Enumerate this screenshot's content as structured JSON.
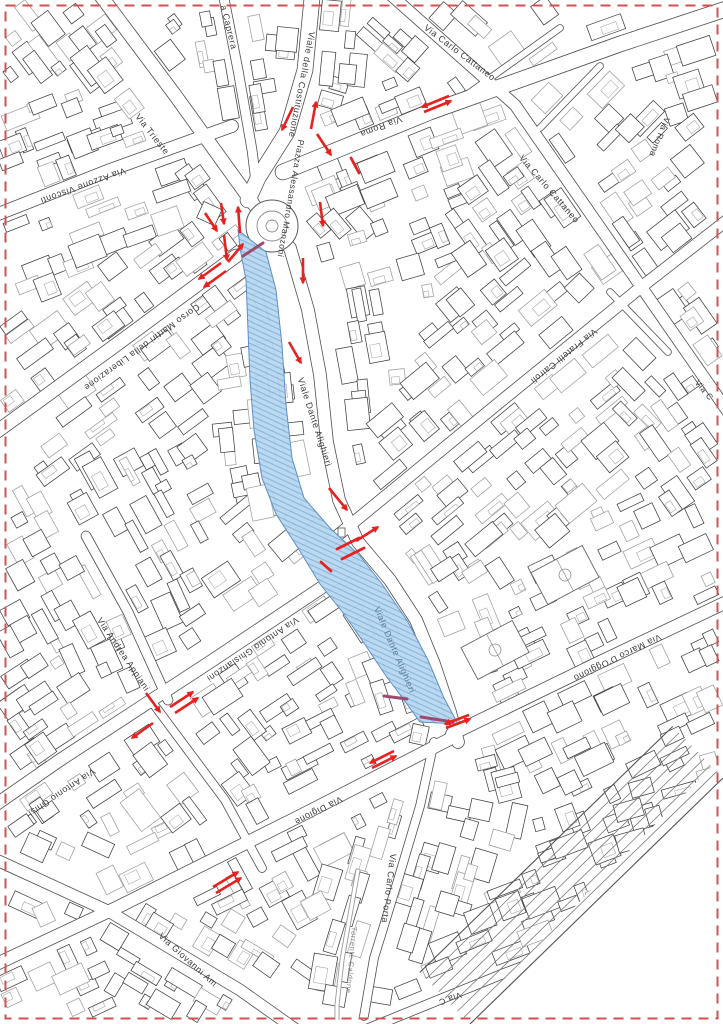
{
  "map": {
    "region_description": "City-centre cadastral street map with highlighted pedestrian zone and traffic-change arrows",
    "colors": {
      "arrow": "#e8211f",
      "zone_fill": "#b7d7f0",
      "zone_hatch": "#84b2da",
      "zone_edge": "#5c8fc4",
      "zone_accent": "#9c4b6e",
      "border": "#d45050",
      "label": "#3c3c3c",
      "water_label": "#8a8a8a",
      "zone_label": "#5e7a9b"
    },
    "street_labels": [
      {
        "text": "Via Trieste",
        "x": 150,
        "y": 136,
        "rot": 52,
        "size": 9
      },
      {
        "text": "a Caprera",
        "x": 226,
        "y": 28,
        "rot": 76,
        "size": 9
      },
      {
        "text": "Viale della Costituzione",
        "x": 299,
        "y": 84,
        "rot": 101,
        "size": 9
      },
      {
        "text": "Via Carlo Cattaneo",
        "x": 458,
        "y": 55,
        "rot": 37,
        "size": 9
      },
      {
        "text": "Via Roma",
        "x": 380,
        "y": 124,
        "rot": 159,
        "size": 9
      },
      {
        "text": "Via Roma",
        "x": 657,
        "y": 136,
        "rot": 112,
        "size": 8.5
      },
      {
        "text": "Via Carlo Cattaneo",
        "x": 547,
        "y": 191,
        "rot": 49,
        "size": 9
      },
      {
        "text": "Via Azzone Visconti",
        "x": 82,
        "y": 183,
        "rot": 160,
        "size": 9
      },
      {
        "text": "Piazza Alessandro Manzoni",
        "x": 288,
        "y": 198,
        "rot": 100,
        "size": 8.5
      },
      {
        "text": "Corso Martiri della Liberazione",
        "x": 140,
        "y": 345,
        "rot": 144,
        "size": 9
      },
      {
        "text": "Viale Dante Alighieri",
        "x": 312,
        "y": 423,
        "rot": 72,
        "size": 9
      },
      {
        "text": "Via Fratelli Cairoli",
        "x": 562,
        "y": 354,
        "rot": 141,
        "size": 9
      },
      {
        "text": "Via C",
        "x": 702,
        "y": 392,
        "rot": 50,
        "size": 8.5
      },
      {
        "text": "Viale Dante Alighieri",
        "x": 392,
        "y": 651,
        "rot": 67,
        "size": 9,
        "color": "zone_label"
      },
      {
        "text": "Via Antonio Ghislanzoni",
        "x": 251,
        "y": 647,
        "rot": 146,
        "size": 9
      },
      {
        "text": "Via Andrea Appiani",
        "x": 121,
        "y": 656,
        "rot": 56,
        "size": 9
      },
      {
        "text": "Via Marco D'Oggiono",
        "x": 616,
        "y": 655,
        "rot": 154,
        "size": 9
      },
      {
        "text": "Via Antonio Ghisl",
        "x": 60,
        "y": 790,
        "rot": 146,
        "size": 9
      },
      {
        "text": "Via Digione",
        "x": 317,
        "y": 808,
        "rot": 153,
        "size": 9
      },
      {
        "text": "Via Carlo Porta",
        "x": 386,
        "y": 888,
        "rot": 97,
        "size": 9
      },
      {
        "text": "Torrente Caldone",
        "x": 349,
        "y": 960,
        "rot": 95,
        "size": 7.5,
        "color": "water_label"
      },
      {
        "text": "Via Giovanni Am",
        "x": 186,
        "y": 962,
        "rot": 42,
        "size": 9
      },
      {
        "text": "Via C",
        "x": 449,
        "y": 996,
        "rot": 160,
        "size": 8.5
      }
    ],
    "traffic_arrows": [
      {
        "x1": 424,
        "y1": 112,
        "x2": 451,
        "y2": 101
      },
      {
        "x1": 449,
        "y1": 96,
        "x2": 422,
        "y2": 107
      },
      {
        "x1": 293,
        "y1": 107,
        "x2": 282,
        "y2": 130
      },
      {
        "x1": 311,
        "y1": 129,
        "x2": 316,
        "y2": 102
      },
      {
        "x1": 317,
        "y1": 134,
        "x2": 331,
        "y2": 155
      },
      {
        "x1": 205,
        "y1": 213,
        "x2": 217,
        "y2": 231
      },
      {
        "x1": 221,
        "y1": 203,
        "x2": 224,
        "y2": 224
      },
      {
        "x1": 240,
        "y1": 233,
        "x2": 238,
        "y2": 207
      },
      {
        "x1": 224,
        "y1": 235,
        "x2": 227,
        "y2": 260
      },
      {
        "x1": 228,
        "y1": 262,
        "x2": 243,
        "y2": 244
      },
      {
        "x1": 221,
        "y1": 263,
        "x2": 199,
        "y2": 279
      },
      {
        "x1": 226,
        "y1": 271,
        "x2": 204,
        "y2": 287
      },
      {
        "x1": 320,
        "y1": 202,
        "x2": 323,
        "y2": 226
      },
      {
        "x1": 303,
        "y1": 258,
        "x2": 303,
        "y2": 283
      },
      {
        "x1": 289,
        "y1": 342,
        "x2": 301,
        "y2": 363
      },
      {
        "x1": 329,
        "y1": 488,
        "x2": 347,
        "y2": 510
      },
      {
        "x1": 356,
        "y1": 541,
        "x2": 378,
        "y2": 527
      },
      {
        "x1": 446,
        "y1": 728,
        "x2": 470,
        "y2": 719
      },
      {
        "x1": 469,
        "y1": 715,
        "x2": 445,
        "y2": 724
      },
      {
        "x1": 372,
        "y1": 768,
        "x2": 396,
        "y2": 756
      },
      {
        "x1": 394,
        "y1": 751,
        "x2": 370,
        "y2": 763
      },
      {
        "x1": 146,
        "y1": 693,
        "x2": 160,
        "y2": 712
      },
      {
        "x1": 170,
        "y1": 707,
        "x2": 193,
        "y2": 692
      },
      {
        "x1": 175,
        "y1": 713,
        "x2": 198,
        "y2": 698
      },
      {
        "x1": 153,
        "y1": 723,
        "x2": 132,
        "y2": 738
      },
      {
        "x1": 213,
        "y1": 887,
        "x2": 238,
        "y2": 872
      },
      {
        "x1": 216,
        "y1": 893,
        "x2": 241,
        "y2": 878
      }
    ],
    "closure_ticks": [
      {
        "x1": 351,
        "y1": 158,
        "x2": 359,
        "y2": 173
      },
      {
        "x1": 337,
        "y1": 549,
        "x2": 359,
        "y2": 538
      },
      {
        "x1": 342,
        "y1": 559,
        "x2": 364,
        "y2": 548
      },
      {
        "x1": 321,
        "y1": 562,
        "x2": 331,
        "y2": 571
      }
    ],
    "zone_accent_edges": [
      {
        "x1": 243,
        "y1": 256,
        "x2": 263,
        "y2": 243
      },
      {
        "x1": 384,
        "y1": 696,
        "x2": 407,
        "y2": 699
      },
      {
        "x1": 421,
        "y1": 717,
        "x2": 453,
        "y2": 722
      }
    ]
  }
}
